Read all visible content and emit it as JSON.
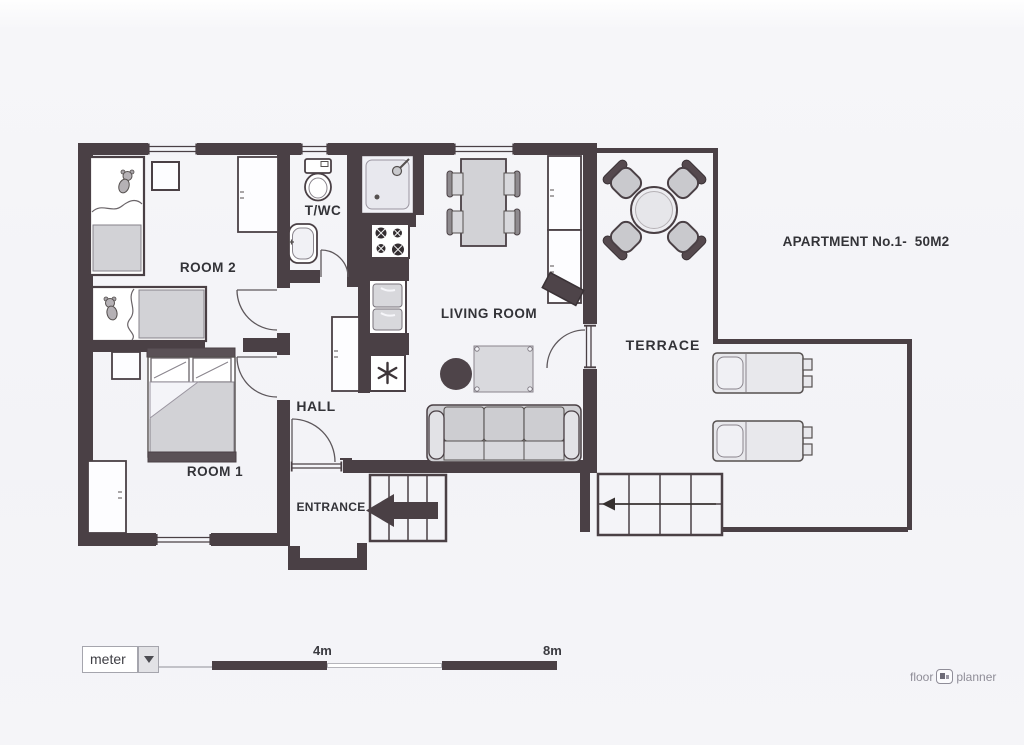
{
  "title": "APARTMENT No.1-  50M2",
  "rooms": {
    "room2": "ROOM 2",
    "twc": "T/WC",
    "hall": "HALL",
    "room1": "ROOM 1",
    "living_room": "LIVING ROOM",
    "entrance": "ENTRANCE",
    "terrace": "TERRACE"
  },
  "scale_bar": {
    "unit_label": "meter",
    "mid_label": "4m",
    "end_label": "8m"
  },
  "branding": {
    "word1": "floor",
    "word2": "planner"
  },
  "colors": {
    "wall": "#4a4045",
    "floor": "#f4f4f8",
    "furniture": "#d2d2d6",
    "furniture_light": "#e9e9ed",
    "label_text": "#333338",
    "logo_text": "#8f8d98"
  }
}
